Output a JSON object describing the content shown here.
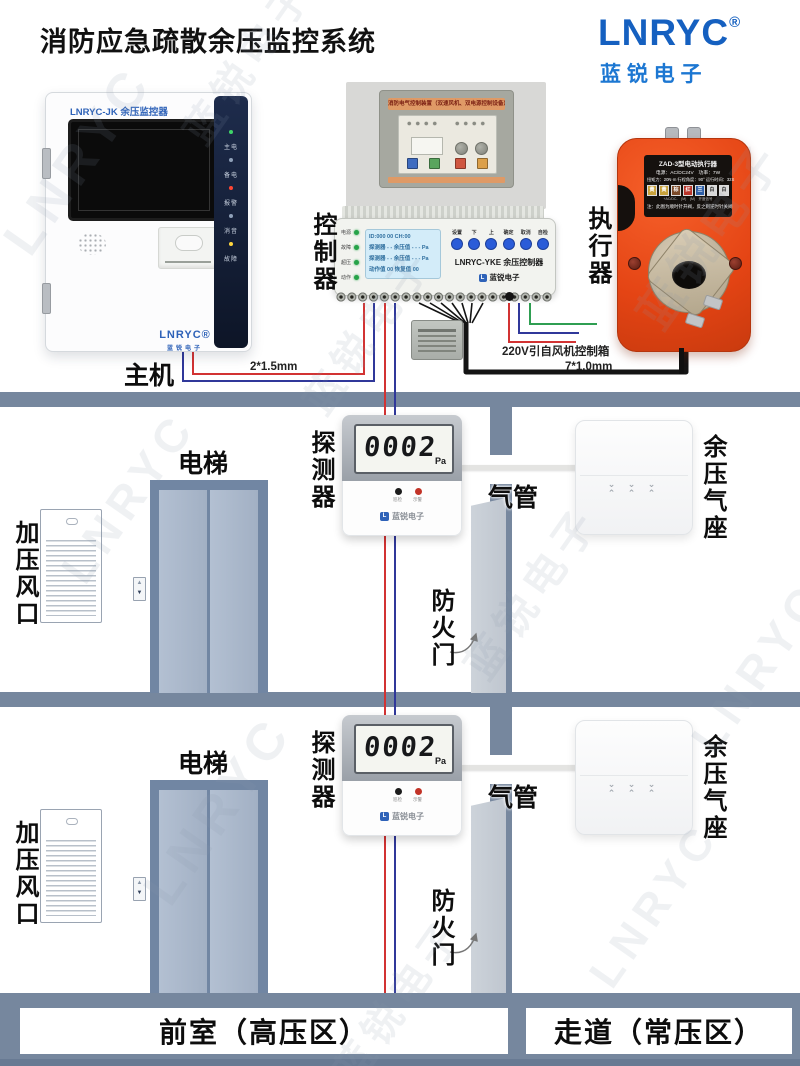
{
  "header": {
    "title": "消防应急疏散余压监控系统"
  },
  "brand": {
    "logo": "LNRYC",
    "reg": "®",
    "subtitle": "蓝 锐 电 子"
  },
  "watermark": {
    "text_en": "LNRYC",
    "text_cn": "蓝锐电子"
  },
  "host": {
    "section_label": "主机",
    "model": "LNRYC-JK 余压监控器",
    "leds": [
      {
        "label": "主电",
        "color": "#3FD469"
      },
      {
        "label": "备电",
        "color": "#8FA0B8"
      },
      {
        "label": "报警",
        "color": "#FF4633"
      },
      {
        "label": "消音",
        "color": "#8FA0B8"
      },
      {
        "label": "故障",
        "color": "#FFD53E"
      }
    ],
    "logo": "LNRYC®",
    "logo_sub": "蓝锐电子",
    "cable_label": "2*1.5mm"
  },
  "control_box": {
    "banner": "消防电气控制装置（双速风机、双电源控制设备）"
  },
  "controller": {
    "section_label": "控制器",
    "model": "LNRYC-YKE 余压控制器",
    "brand": "蓝锐电子",
    "brand_icon": "L",
    "lcd": [
      "ID:000  00  CH:00",
      "探测器 - -  余压值 - - - Pa",
      "探测器 - -  余压值 - - - Pa",
      "动作值 00   恢复值 00"
    ],
    "buttons": [
      "设置",
      "下",
      "上",
      "确定",
      "取消",
      "自检"
    ],
    "leds": [
      "电源",
      "故障",
      "超压",
      "动作"
    ],
    "power_label": "220V引自风机控制箱",
    "cable_label": "7*1.0mm"
  },
  "actuator": {
    "section_label": "执行器",
    "title": "ZAD-3型电动执行器",
    "spec1": "电源：AC/DC24V　功率：7W",
    "spec2": "扭矩力：20N·m 行程角度：90° 运行时间：32S",
    "wires": [
      "黄",
      "黄",
      "棕",
      "红",
      "兰",
      "白",
      "白"
    ],
    "wire_sub": "+AC/DC-　(M)　(M)　开度信号",
    "note": "注：此图为顺时针开阀，反之则逆时针关阀"
  },
  "floors": [
    {
      "vent": "加压风口",
      "elevator": "电梯",
      "detector": "探测器",
      "lcd_value": "0002",
      "lcd_unit": "Pa",
      "led1": "巡检",
      "led2": "示警",
      "brand": "蓝锐电子",
      "brand_icon": "L",
      "pipe": "气管",
      "seat": "余压气座",
      "vent_top": "⌄ ⌄ ⌄",
      "vent_bottom": "⌃ ⌃ ⌃",
      "door": "防火门"
    },
    {
      "vent": "加压风口",
      "elevator": "电梯",
      "detector": "探测器",
      "lcd_value": "0002",
      "lcd_unit": "Pa",
      "led1": "巡检",
      "led2": "示警",
      "brand": "蓝锐电子",
      "brand_icon": "L",
      "pipe": "气管",
      "seat": "余压气座",
      "vent_top": "⌄ ⌄ ⌄",
      "vent_bottom": "⌃ ⌃ ⌃",
      "door": "防火门"
    }
  ],
  "footer": {
    "left": "前室（高压区）",
    "right": "走道（常压区）"
  },
  "colors": {
    "wall": "#76879E",
    "brand_blue": "#1560C0",
    "actuator_orange": "#E8491D",
    "wire_red": "#D23333",
    "wire_blue": "#30389A",
    "wire_green": "#2F9E52"
  }
}
